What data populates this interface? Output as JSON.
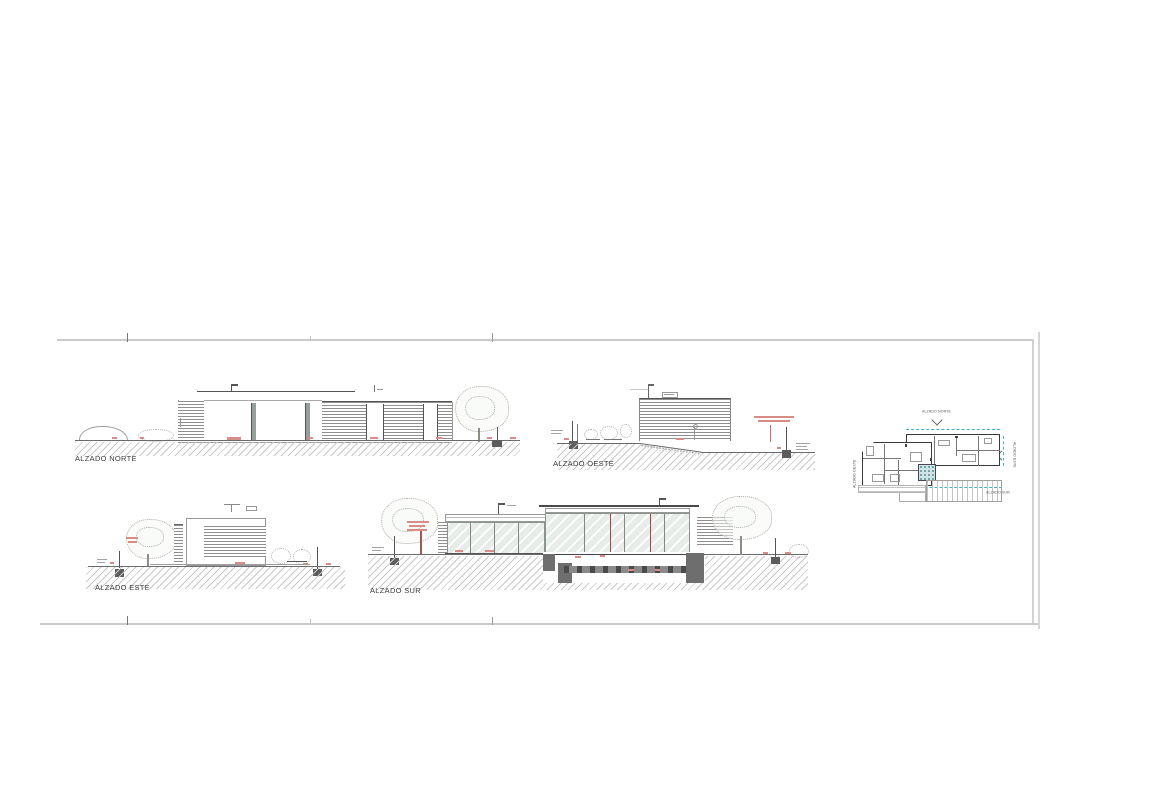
{
  "sheet": {
    "background": "#ffffff"
  },
  "titles": {
    "norte": "ALZADO NORTE",
    "oeste": "ALZADO OESTE",
    "este": "ALZADO ESTE",
    "sur": "ALZADO SUR"
  },
  "plan": {
    "label_top": "ALZADO NORTE",
    "label_left": "ALZADO OESTE",
    "label_right": "ALZADO ESTE",
    "label_bottom": "ALZADO SUR"
  },
  "colors": {
    "frame_line": "#cbcbcb",
    "ground_line": "#6b6b6b",
    "hatch": "#c8c8c8",
    "louver": "#8f8f8f",
    "glass": "#e8ece9",
    "glass_frame": "#8a938d",
    "annotation_red": "#cc6b6b",
    "annotation_pink": "#d98c86",
    "cyan_dashed": "#3fb4c4",
    "foundation_dark": "#6e6e6e",
    "foliage": "#a8b1a4",
    "trunk_red": "#9c5a50"
  }
}
